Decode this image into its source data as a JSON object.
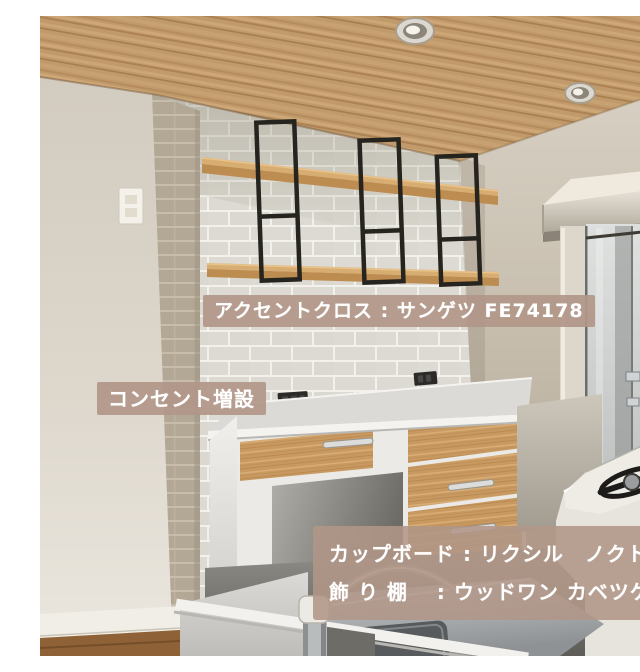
{
  "image": {
    "kind": "kitchen interior photograph with renovation notes",
    "overlay_labels": {
      "accent_wall": "アクセントクロス : サンゲツ FE74178",
      "outlet_note": "コンセント増設",
      "spec_line1": "カップボード : リクシル　ノクト",
      "spec_line2": "飾 り 棚　 : ウッドワン カベツケ"
    },
    "colors": {
      "label_background": "#b29789",
      "label_text": "#ffffff",
      "ceiling_wood": "#c19a6b",
      "wall_beige": "#d6cfc4",
      "tile_face": "#dcdad2",
      "tile_grout": "#f2f1ec",
      "shelf_wood": "#c9995c",
      "iron_frame": "#26241f",
      "cupboard_wood": "#c89a62",
      "countertop_white": "#ebe9e4",
      "stainless_steel": "#c3c6c7"
    }
  }
}
